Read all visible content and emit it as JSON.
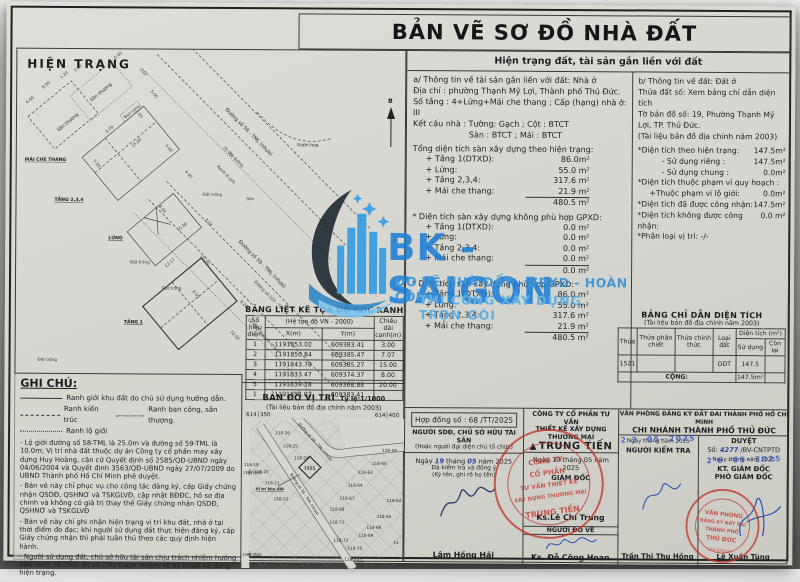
{
  "title": "BẢN VẼ SƠ ĐỒ NHÀ ĐẤT",
  "colors": {
    "paper": "#d7d7d1",
    "ink": "#1d1d1d",
    "watermark_blue": "#1d7fd6",
    "stamp_red": "#c0392b",
    "pen_blue": "#2b3f9e",
    "date_stamp_blue": "#3a57c4"
  },
  "watermark": {
    "brand": "BK -SAIGON",
    "line1": "ĐO VẼ NHÀ ĐẤT - XPXD - HOÀN CÔNG",
    "line2": "THI CÔNG XÂY DỰNG TRỌN GÓI"
  },
  "drawing": {
    "title": "HIỆN TRẠNG",
    "north_label": "B",
    "labels": {
      "san_thuong": "Sân thượng",
      "mai_che_thang": "MÁI CHE THANG",
      "tang234": "TẦNG 2,3,4",
      "lung": "LỬNG",
      "tang1": "TẦNG 1",
      "dat_trong": "Đất trống",
      "san": "Sân",
      "vuon_hoa": "Vườn hoa",
      "ban_cong": "Ban công",
      "street58": "Đường số 58 - TML (nhựa)",
      "street59": "Đường số 59 - TML (nhựa)",
      "street103": "Đường số 103 - TML",
      "le_duong": "Lề đường",
      "ranh_lo_gioi": "Ranh lộ giới"
    },
    "dimensions": [
      "5.60",
      "3.67",
      "5.00",
      "6.60",
      "1.20",
      "3.60",
      "8.00",
      "0.70",
      "7.50",
      "15.00",
      "7.00",
      "3.00",
      "4.00",
      "8.00",
      "12.17",
      "15.00",
      "7.07",
      "20.00",
      "25.0m",
      "10.00",
      "6.20",
      "8.00"
    ]
  },
  "right_panel": {
    "header": "Hiện trạng đất, tài sản gắn liền với đất",
    "asset": {
      "heading": "a/ Thông tin về tài sản gắn liền với đất: Nhà ở",
      "address": "Địa chỉ : phường Thạnh Mỹ Lợi, Thành phố Thủ Đức.",
      "floors": "Số tầng : 4+Lửng+Mái che thang ; Cấp (hạng) nhà ở:  III",
      "structure1": "Kết cấu nhà : Tường:  Gạch   ; Cột :   BTCT",
      "structure2": "Sàn :   BTCT   ; Mái :   BTCT",
      "sections": [
        {
          "heading": "Tổng diện tích sàn xây dựng theo hiện trạng:",
          "rows": [
            [
              "+ Tầng 1(DTXD):",
              "86.0m²"
            ],
            [
              "+ Lửng:",
              "55.0 m²"
            ],
            [
              "+ Tầng 2,3,4:",
              "317.6 m²"
            ],
            [
              "+ Mái che thang:",
              "21.9 m²"
            ]
          ],
          "total": "480.5 m²"
        },
        {
          "heading": "* Diện tích sàn xây dựng không phù hợp GPXD:",
          "rows": [
            [
              "+ Tầng 1(DTXD):",
              "0.0 m²"
            ],
            [
              "+ Lửng:",
              "0.0 m²"
            ],
            [
              "+ Tầng 2,3,4:",
              "0.0 m²"
            ],
            [
              "+ Mái che thang:",
              "0.0 m²"
            ]
          ],
          "total": "0.0 m²"
        },
        {
          "heading": "* Diện tích sàn xây dựng phù hợp GPXD:",
          "rows": [
            [
              "+ Tầng 1(DTXD):",
              "86.0 m²"
            ],
            [
              "+ Lửng:",
              "55.0 m²"
            ],
            [
              "+ Tầng 2,3,4:",
              "317.6 m²"
            ],
            [
              "+ Mái che thang:",
              "21.9 m²"
            ]
          ],
          "total": "480.5 m²"
        }
      ]
    },
    "land": {
      "heading": "b/ Thông tin về đất: Đất ở",
      "parcel": "Thửa đất số:  Xem bảng chỉ dẫn diện tích",
      "sheet": "Tờ bản đồ số:  19, Phường Thạnh Mỹ Lợi, TP. Thủ Đức.",
      "doc": "(Tài liệu bản đồ địa chính năm 2003)",
      "rows": [
        {
          "label": "*Diện tích theo hiện trạng:",
          "value": "147.5m²",
          "ind": 0
        },
        {
          "label": "- Sử dụng riêng :",
          "value": "147.5m²",
          "ind": 2
        },
        {
          "label": "- Sử dụng chung :",
          "value": "0.0m²",
          "ind": 2
        },
        {
          "label": "*Diện tích thuộc phạm vi quy hoạch :",
          "value": "",
          "ind": 0
        },
        {
          "label": "+Thuộc phạm vi lộ giới:",
          "value": "0.0m²",
          "ind": 1
        },
        {
          "label": "*Diện tích đã được công nhận:",
          "value": "147.5m²",
          "ind": 0
        },
        {
          "label": "*Diện tích không được công nhận:",
          "value": "0.0 m²",
          "ind": 0
        },
        {
          "label": "*Phân loại vị trí:  -/-",
          "value": "",
          "ind": 0
        }
      ]
    }
  },
  "coord_table": {
    "title": "BẢNG LIỆT KÊ TỌA ĐỘ GÓC RANH",
    "col_point": "Số hiệu điểm",
    "col_sys": "(Hệ tọa độ VN - 2000)",
    "col_x": "X(m)",
    "col_y": "Y(m)",
    "col_len": "Chiều dài cạnh(m)",
    "rows": [
      [
        "1",
        "1191853.02",
        "609383.41",
        "3.00"
      ],
      [
        "2",
        "1191850.84",
        "609385.47",
        "7.07"
      ],
      [
        "3",
        "1191843.78",
        "609385.27",
        "15.00"
      ],
      [
        "4",
        "1191833.47",
        "609374.37",
        "8.00"
      ],
      [
        "5",
        "1191839.28",
        "609368.88",
        "20.00"
      ],
      [
        "1",
        "1191853.02",
        "609383.41",
        ""
      ]
    ]
  },
  "area_table": {
    "title": "BẢNG CHỈ DẪN DIỆN TÍCH",
    "subtitle": "(Tài liệu bản đồ địa chính năm 2003)",
    "headers": {
      "thua": "Thửa",
      "phan_chiet": "Thửa phân chiết",
      "chinh_thuc": "Thửa chính thức",
      "loai_dat": "Loại đất",
      "dien_tich": "Diện tích (m²)",
      "su_dung": "Sử dụng",
      "con_lai": "Còn lại"
    },
    "row": {
      "thua": "1521",
      "phan_chiet": "",
      "chinh_thuc": "",
      "loai_dat": "ODT",
      "su_dung": "147.5",
      "con_lai": ""
    },
    "total_label": "CỘNG:",
    "total_value": "147.5m²"
  },
  "location_map": {
    "title": "BẢN ĐỒ VỊ TRÍ",
    "scale": "Tỷ lệ:1/1000",
    "subtitle": "(Tài liệu bản đồ địa chính năm 2003)",
    "coord_tl": "614│350",
    "coord_tr": "614│400",
    "coord_l1": "1191│850",
    "coord_l2": "1191│800",
    "site_label": "Vị trí khu đất",
    "site_lot": "1521",
    "street58": "Đường số 58 - TML (nhựa)",
    "street59": "Đường số 59 - TML (nhựa)",
    "lots": [
      "118-26",
      "118-25",
      "118-24",
      "118-19",
      "118-20",
      "118-21",
      "118-22",
      "118-59",
      "118-60",
      "118-63",
      "118-64",
      "118-67",
      "118-68",
      "118-62",
      "118-65",
      "118-66",
      "118-71",
      "118-69",
      "118-72",
      "118-70",
      "118-73",
      "15"
    ]
  },
  "notes": {
    "title": "GHI CHÚ:",
    "legend": [
      {
        "style": "solid",
        "label": "Ranh giới khu đất do chủ sử dụng hướng dẫn."
      },
      {
        "style": "dashed",
        "label": "Ranh kiến trúc"
      },
      {
        "style": "dotted",
        "label": "Ranh ban công, sân thượng."
      },
      {
        "style": "dotted",
        "label": "Ranh lộ giới"
      }
    ],
    "paragraphs": [
      "- Lộ giới đường số 58-TML là 25.0m và đường số 59-TML là 10.0m; Vị trí nhà đất thuộc dự án Công ty cổ phần may xây dựng Huy Hoàng, căn cứ Quyết định số 2585/QĐ-UBND ngày 04/06/2004 và Quyết định 3563/QĐ-UBND ngày 27/07/2009 do UBND Thành phố Hồ Chí Minh phê duyệt.",
      "- Bản vẽ này chỉ phục vụ cho công tác đăng ký, cấp Giấy chứng nhận QSDĐ, QSHNƠ và TSKGLVĐ, cập nhật BĐĐC, hồ sơ địa chính và không có giá trị thay thế Giấy chứng nhận QSDĐ, QSHNƠ và TSKGLVĐ",
      "- Bản vẽ này chỉ ghi nhận hiện trạng vị trí khu đất, nhà ở tại thời điểm đo đạc; khi người sử dụng đất thực hiện đăng ký, cấp Giấy chứng nhận thì phải tuân thủ theo các quy định hiện hành.",
      "- Người sử dụng đất, chủ sở hữu tài sản chịu trách nhiệm hướng dẫn ranh, tổ chức đo vẽ chịu trách nhiệm về kỹ thuật và đúng hiện trạng."
    ]
  },
  "signoff": {
    "contract": "Hợp đồng số : 68 /TT/2025",
    "owner": {
      "title": "NGƯỜI SDĐ, CHỦ SỞ HỮU TÀI SẢN",
      "subtitle": "(Hoặc người đại diện chủ tổ chức)",
      "d_w1": "Ngày",
      "d_d": "19",
      "d_w2": "tháng",
      "d_m": "05",
      "d_w3": "năm 2025",
      "line1": "Đã kiểm tra và đồng ý",
      "line2": "(Ký tên, ghi rõ họ tên)",
      "name": "Lâm Hồng Hải"
    },
    "company": {
      "title1": "CÔNG TY CỔ PHẦN TƯ VẤN",
      "title2": "THIẾT KẾ XÂY DỰNG THƯƠNG MẠI",
      "logo_glyph": "▲",
      "brand": "TRUNG TIẾN",
      "date": "Ngày 19 tháng 05 năm 2025",
      "role": "GIÁM ĐỐC",
      "name": "Ks.Lê Chí Trung",
      "surveyor_title": "NGƯỜI ĐO VẼ",
      "surveyor_name": "Ks. Đỗ Công Hoan",
      "stamp": {
        "l1": "CÔNG TY",
        "l2": "CỔ PHẦN",
        "l3": "TƯ VẤN THIẾT KẾ",
        "l4": "XÂY DỰNG THƯƠNG MẠI",
        "l5": "TRUNG TIẾN"
      }
    },
    "office": {
      "title": "VĂN PHÒNG ĐĂNG KÝ ĐẤT ĐAI THÀNH PHỐ HỒ CHÍ MINH",
      "branch": "CHI NHÁNH THÀNH PHỐ THỦ ĐỨC",
      "checker": {
        "date_base": "Ngày        tháng        năm 2025",
        "date_stamp": "2 2 -05- 2025",
        "role": "NGƯỜI KIỂM TRA",
        "name": "Trần Thị Thu Hồng"
      },
      "approver": {
        "title": "DUYỆT",
        "num_label": "Số:",
        "num": "4277",
        "num_suffix": "/BV-CNTPTD",
        "date_base": "Ngày      tháng      năm 2025",
        "date_stamp": "2 6 -05- 2025",
        "role1": "KT. GIÁM ĐỐC",
        "role2": "PHÓ GIÁM ĐỐC",
        "name": "Lê Xuân Tùng"
      },
      "stamp": {
        "l1": "VĂN PHÒNG",
        "l2": "ĐĂNG KÝ ĐẤT ĐAI",
        "l3": "THÀNH PHỐ",
        "l4": "THỦ ĐỨC",
        "l5": "CHI NHÁNH"
      }
    }
  }
}
